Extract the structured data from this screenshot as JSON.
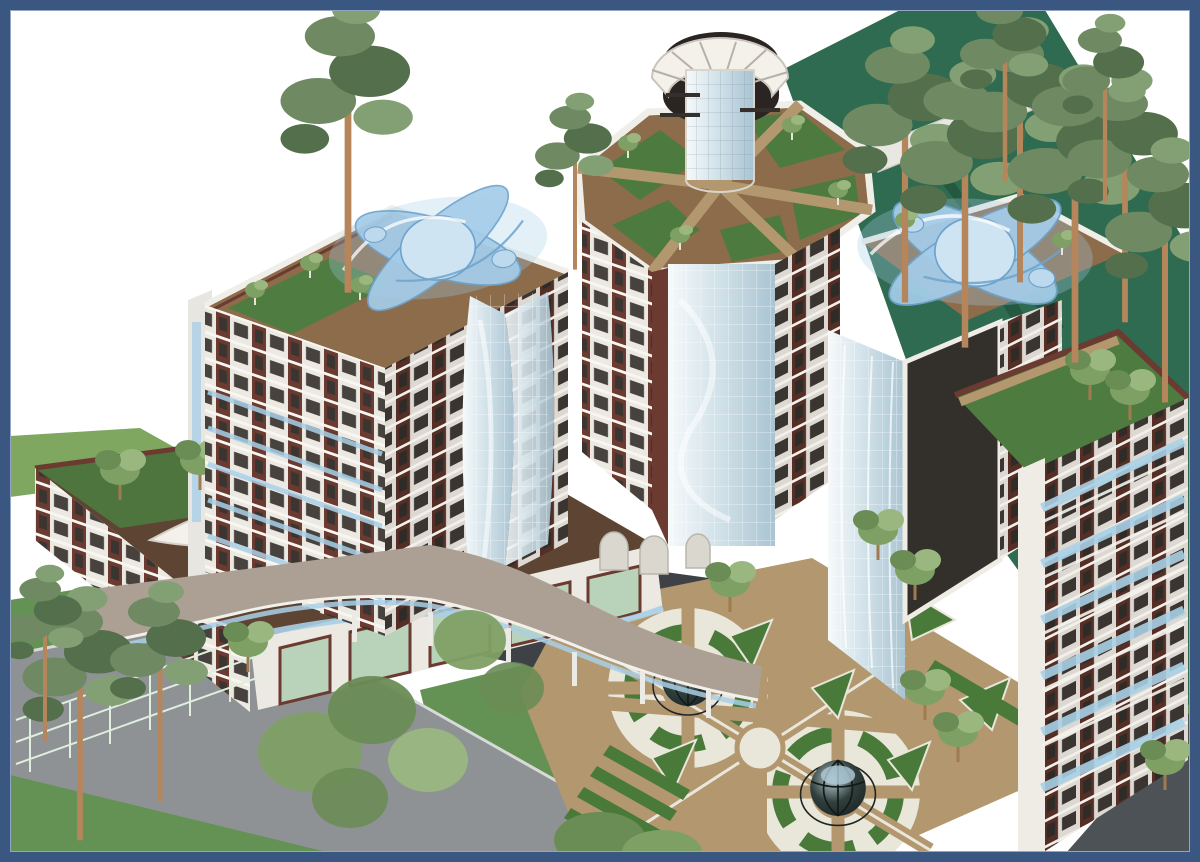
{
  "meta": {
    "artifact": "architectural-rendering",
    "subject": "Aerial 3D rendering of a residential complex: three towers with rooftop gardens and blue sculptural skylight forms, a central octagonal tower with glass turret, glass atriums and cylinders, lower wing with white canopy, formal courtyard garden with two glass-dome gazebos, pine trees, lawns, curved terrace and access roads, framed by a navy border",
    "visible_text": ""
  },
  "palette": {
    "frame": "#3a5781",
    "frame_inner": "#93a5c2",
    "sky": "#ffffff",
    "lawn_dark": "#2e6b50",
    "lawn": "#649254",
    "lawn_light": "#7fa75f",
    "road_gray": "#8f9294",
    "asphalt": "#3e4246",
    "corner_road": "#4d5257",
    "path_tan": "#b2976f",
    "paving_white": "#e9e6da",
    "hedge": "#4a7a3a",
    "facade_white": "#ece9e3",
    "facade_shade": "#ddd9d2",
    "maroon": "#6b3a30",
    "maroon_dark": "#552e26",
    "window_dark": "#3a3531",
    "roof_brown": "#8c6c4b",
    "roof_dark": "#5e4433",
    "glass_hi": "#f6fafb",
    "glass_mid": "#cfe0e8",
    "glass_lo": "#a9c4d2",
    "glass_green": "#b9d2ba",
    "sculpture_blue": "#a5cde9",
    "sculpture_deep": "#6fa3cc",
    "balcony_glass": "#a9cfe6",
    "dome_dark": "#263230",
    "trunk": "#b5855c",
    "pine": "#6f8a63",
    "pine_dark": "#546f4b",
    "pine_light": "#83a074",
    "leaf": "#7fa065",
    "leaf_light": "#9ab77f",
    "leaf_dark": "#6a8c55",
    "terrace_beige": "#aca094",
    "canopy_white": "#f4f1ea",
    "parapet": "#f0eee8"
  },
  "scene": {
    "elements": [
      {
        "id": "frame-border",
        "label": "navy picture frame border"
      },
      {
        "id": "sky",
        "label": "white background"
      },
      {
        "id": "lawn-top-right",
        "label": "dark green lawn behind pine grove"
      },
      {
        "id": "lawn-strip-left",
        "label": "lawn strip at upper left of wing"
      },
      {
        "id": "lawn-bottom-left",
        "label": "fenced lawn, bottom-left"
      },
      {
        "id": "lawn-bottom-center",
        "label": "lawn between road and courtyard"
      },
      {
        "id": "perimeter-road",
        "label": "gray curved road, bottom-left"
      },
      {
        "id": "inner-driveway",
        "label": "dark asphalt inner drive"
      },
      {
        "id": "corner-road",
        "label": "road at bottom-right corner"
      },
      {
        "id": "courtyard-garden",
        "label": "formal parterre garden with tan paths"
      },
      {
        "id": "garden-gazebo-north",
        "label": "glass dome gazebo (north)"
      },
      {
        "id": "garden-gazebo-south",
        "label": "glass dome gazebo (south)"
      },
      {
        "id": "garden-center-circle",
        "label": "central circular plaza"
      },
      {
        "id": "elevated-terrace",
        "label": "beige elevated terrace with wavy glass edge on columns"
      },
      {
        "id": "left-wing",
        "label": "low wing with rooftop garden and white canopy"
      },
      {
        "id": "storefront",
        "label": "ground-floor storefront band with green glazing"
      },
      {
        "id": "left-tower",
        "label": "left residential tower, white and maroon facade"
      },
      {
        "id": "left-tower-sculpture",
        "label": "blue organic skylight sculpture on left tower roof"
      },
      {
        "id": "glass-cylinder-bay",
        "label": "curved glass stair cylinder on left tower"
      },
      {
        "id": "central-tower",
        "label": "octagonal central tower with roof garden"
      },
      {
        "id": "central-turret",
        "label": "glass turret with fan-shaped canopy"
      },
      {
        "id": "central-atrium",
        "label": "full-height glass atrium"
      },
      {
        "id": "right-tower",
        "label": "right residential tower"
      },
      {
        "id": "right-tower-sculpture",
        "label": "blue organic skylight sculpture on right tower roof"
      },
      {
        "id": "right-roof-terrace",
        "label": "planted roof terrace of right tower"
      },
      {
        "id": "balcony-stairs",
        "label": "cascading blue glass balconies"
      },
      {
        "id": "pine-grove",
        "label": "tall pine trees"
      },
      {
        "id": "garden-trees",
        "label": "small deciduous trees"
      }
    ]
  }
}
